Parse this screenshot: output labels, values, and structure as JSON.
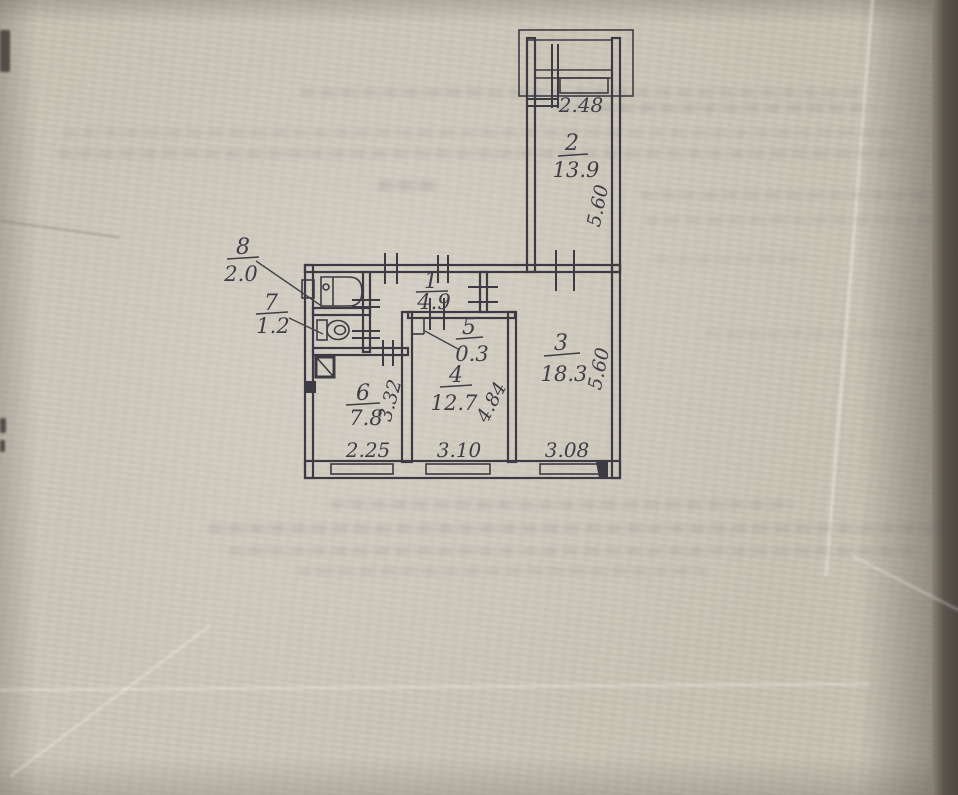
{
  "document": {
    "type": "scanned apartment floor plan, hand-drawn ink on aged paper",
    "ink_color": "#3c3b43",
    "paper_color": "#c8c2b4"
  },
  "rooms": [
    {
      "id": "1",
      "area": "4.9"
    },
    {
      "id": "2",
      "area": "13.9",
      "width": "2.48",
      "depth": "5.60"
    },
    {
      "id": "3",
      "area": "18.3",
      "width": "3.08",
      "depth": "5.60"
    },
    {
      "id": "4",
      "area": "12.7",
      "width": "3.10",
      "depth": "4.84"
    },
    {
      "id": "5",
      "area": "0.3"
    },
    {
      "id": "6",
      "area": "7.8",
      "width": "2.25",
      "depth": "3.32"
    },
    {
      "id": "7",
      "area": "1.2"
    },
    {
      "id": "8",
      "area": "2.0"
    }
  ],
  "icons": [
    "bathtub-icon",
    "toilet-icon",
    "vent-shaft-icon",
    "window-icon",
    "balcony-icon",
    "door-mark-icon"
  ]
}
